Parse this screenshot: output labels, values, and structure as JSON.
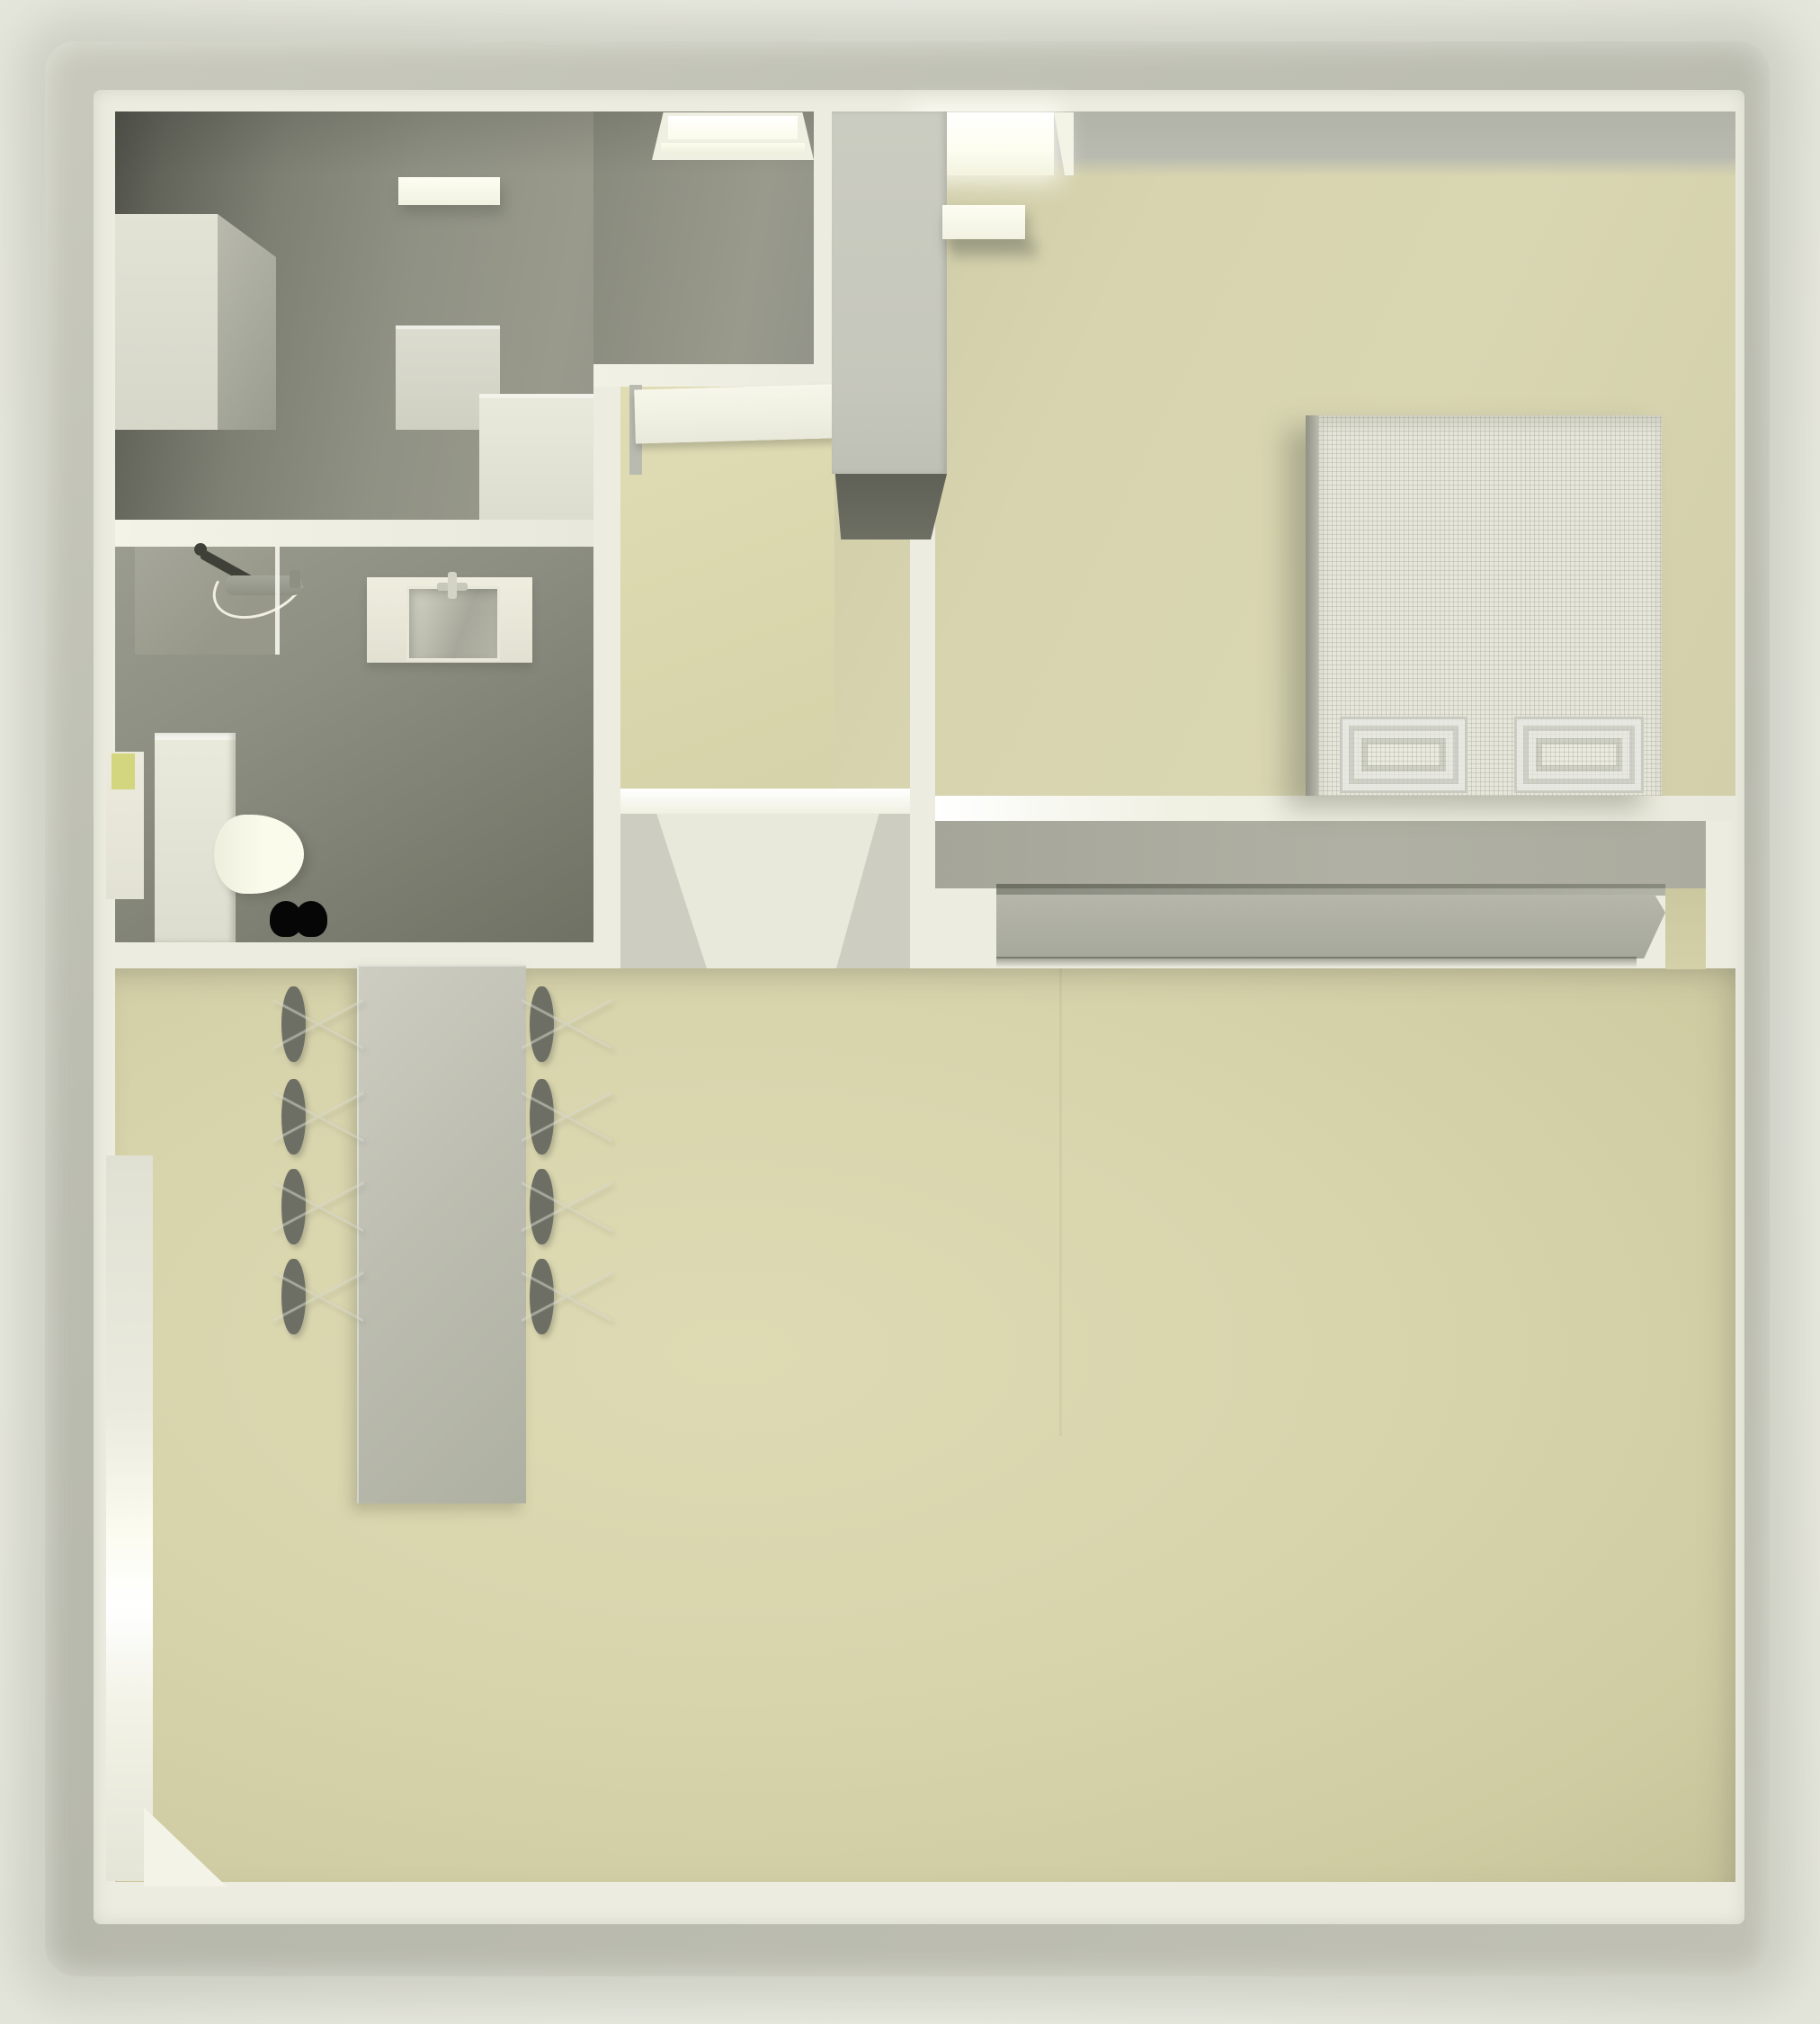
{
  "scene": {
    "type": "3d-floorplan-top-down-render",
    "description": "Top-down 3D rendering of an apartment: two gray-floored rooms (study and bathroom) at upper left, a small hall with an open door in the center, a bedroom with double bed and wardrobe at upper right, and a large living/dining room below with dining table, eight chairs, shelf unit, armchair, coffee table and sofa.",
    "rooms": [
      {
        "id": "study",
        "label": "Study / utility room (gray floor, top left)",
        "floor_color": "#8f9184"
      },
      {
        "id": "bathroom",
        "label": "Bathroom with shower, washbasin and toilet",
        "floor_color": "#83857a"
      },
      {
        "id": "hall",
        "label": "Small hall with open door",
        "floor_color": "#dbd7ae"
      },
      {
        "id": "bedroom",
        "label": "Bedroom with double bed",
        "floor_color": "#d8d4ae"
      },
      {
        "id": "living_dining",
        "label": "Living and dining room",
        "floor_color": "#d7d3aa"
      }
    ],
    "furniture": [
      {
        "name": "tall wardrobe (study, west wall)"
      },
      {
        "name": "low cabinet (study)"
      },
      {
        "name": "corner cabinet (study, southeast)"
      },
      {
        "name": "ceiling light slab (study)"
      },
      {
        "name": "shower with hose and mixer (bathroom)"
      },
      {
        "name": "washbasin counter (bathroom)"
      },
      {
        "name": "tall cabinet (bathroom, west wall)"
      },
      {
        "name": "toilet (bathroom)"
      },
      {
        "name": "open interior door (hall)"
      },
      {
        "name": "wardrobe (bedroom, west side)"
      },
      {
        "name": "ceiling light slab (bedroom)"
      },
      {
        "name": "double bed with two patterned pillows (bedroom)"
      },
      {
        "name": "long sideboard under bedroom wall (living room)"
      },
      {
        "name": "dining table (living room)"
      },
      {
        "name": "dining chairs, 4 left + 4 right",
        "count": 8
      },
      {
        "name": "open shelf / media unit (living room)"
      },
      {
        "name": "armchair, rotated (living room)"
      },
      {
        "name": "coffee table (living room)"
      },
      {
        "name": "sofa (living room, east side)"
      },
      {
        "name": "black slippers beside toilet"
      }
    ],
    "openings": [
      {
        "name": "skylight window, study north wall"
      },
      {
        "name": "bright window, bedroom north wall"
      },
      {
        "name": "small window, bathroom west wall",
        "glass_color": "#d4d67f"
      },
      {
        "name": "tall window band, living room west wall"
      },
      {
        "name": "window bay, living room east wall",
        "glass_color": "#d2d483"
      },
      {
        "name": "window with sill, south wall left"
      },
      {
        "name": "window sill, south wall center-left"
      },
      {
        "name": "door panel opening, south wall center",
        "count": 2
      },
      {
        "name": "corner opening, south wall right"
      }
    ],
    "palette": {
      "floor_beige": "#d7d3ab",
      "floor_gray": "#8f9184",
      "wall_white": "#ecece0",
      "wall_gray_face": "#aaab9e",
      "outer_wall": "#bcbdb1",
      "fabric_light": "#e7e7db",
      "chair_gray": "#6d6f64",
      "furniture_gray": "#b3b4a7",
      "window_glass_yellow": "#d4d67f",
      "deep_shadow": "#5a5c52",
      "black_accent": "#060606"
    }
  }
}
